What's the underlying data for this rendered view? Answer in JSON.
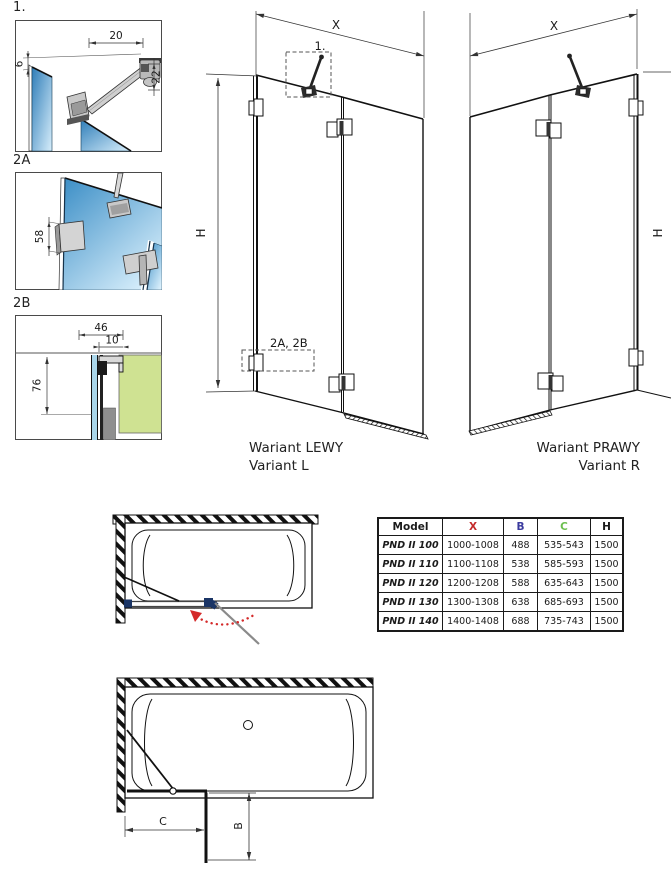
{
  "details": {
    "d1": {
      "label": "1.",
      "dim_top": "20",
      "dim_left": "6",
      "dim_right": "22"
    },
    "d2a": {
      "label": "2A",
      "dim_side": "58"
    },
    "d2b": {
      "label": "2B",
      "dim_depth": "46",
      "dim_inner": "10",
      "dim_height": "76"
    }
  },
  "variant_left": {
    "dim_width": "X",
    "dim_height": "H",
    "ref_detail1": "1.",
    "ref_details2": "2A, 2B",
    "caption_line1": "Wariant LEWY",
    "caption_line2": "Variant L"
  },
  "variant_right": {
    "dim_width": "X",
    "dim_height": "H",
    "caption_line1": "Wariant PRAWY",
    "caption_line2": "Variant R"
  },
  "plan_views": {
    "dim_b": "B",
    "dim_c": "C"
  },
  "size_table": {
    "headers": [
      "Model",
      "X",
      "B",
      "C",
      "H"
    ],
    "rows": [
      [
        "PND II 100",
        "1000-1008",
        "488",
        "535-543",
        "1500"
      ],
      [
        "PND II 110",
        "1100-1108",
        "538",
        "585-593",
        "1500"
      ],
      [
        "PND II 120",
        "1200-1208",
        "588",
        "635-643",
        "1500"
      ],
      [
        "PND II 130",
        "1300-1308",
        "638",
        "685-693",
        "1500"
      ],
      [
        "PND II 140",
        "1400-1408",
        "688",
        "735-743",
        "1500"
      ]
    ]
  },
  "colors": {
    "dim_x_red": "#c42a2a",
    "dim_b_blue": "#3a3a9e",
    "dim_c_green": "#6cbf4f",
    "glass_blue_dark": "#2e7db8",
    "glass_blue_light": "#d7eefb",
    "tub_rim_green": "#cfe292",
    "glass_strip_blue": "#a9d6ea",
    "hinge_navy": "#1b3566",
    "swing_arrow_red": "#d42a2a"
  }
}
